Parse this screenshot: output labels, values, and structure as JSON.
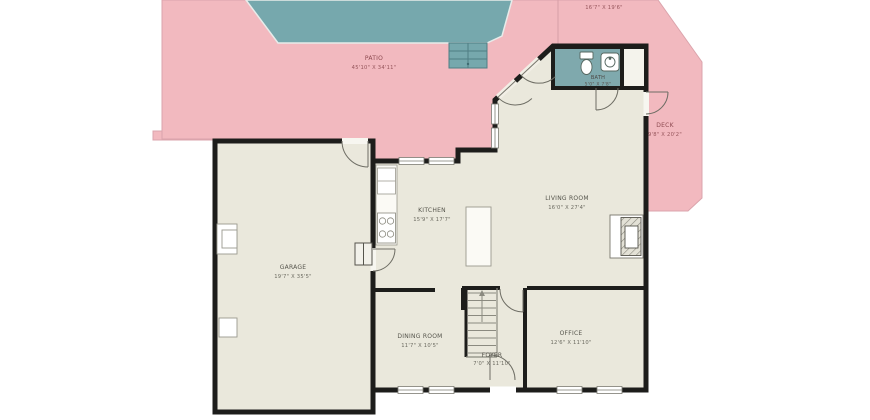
{
  "plan": {
    "outdoor": {
      "patio": {
        "name": "PATIO",
        "dims": "45'10\" X 34'11\""
      },
      "upper_deck": {
        "dims": "16'7\" X 19'6\""
      },
      "deck": {
        "name": "DECK",
        "dims": "9'8\" X 20'2\""
      }
    },
    "rooms": {
      "bath": {
        "name": "BATH",
        "dims": "5'0\" X 7'8\""
      },
      "kitchen": {
        "name": "KITCHEN",
        "dims": "15'9\" X 17'7\""
      },
      "living_room": {
        "name": "LIVING ROOM",
        "dims": "16'0\" X 27'4\""
      },
      "garage": {
        "name": "GARAGE",
        "dims": "19'7\" X 35'5\""
      },
      "dining_room": {
        "name": "DINING ROOM",
        "dims": "11'7\" X 10'5\""
      },
      "office": {
        "name": "OFFICE",
        "dims": "12'6\" X 11'10\""
      },
      "foyer": {
        "name": "FOYER",
        "dims": "7'0\" X 11'10\""
      }
    },
    "colors": {
      "patio_fill": "#f2b9bf",
      "pool_fill": "#76a8ad",
      "floor_fill": "#eae8dc",
      "wall": "#1d1d1b"
    }
  }
}
